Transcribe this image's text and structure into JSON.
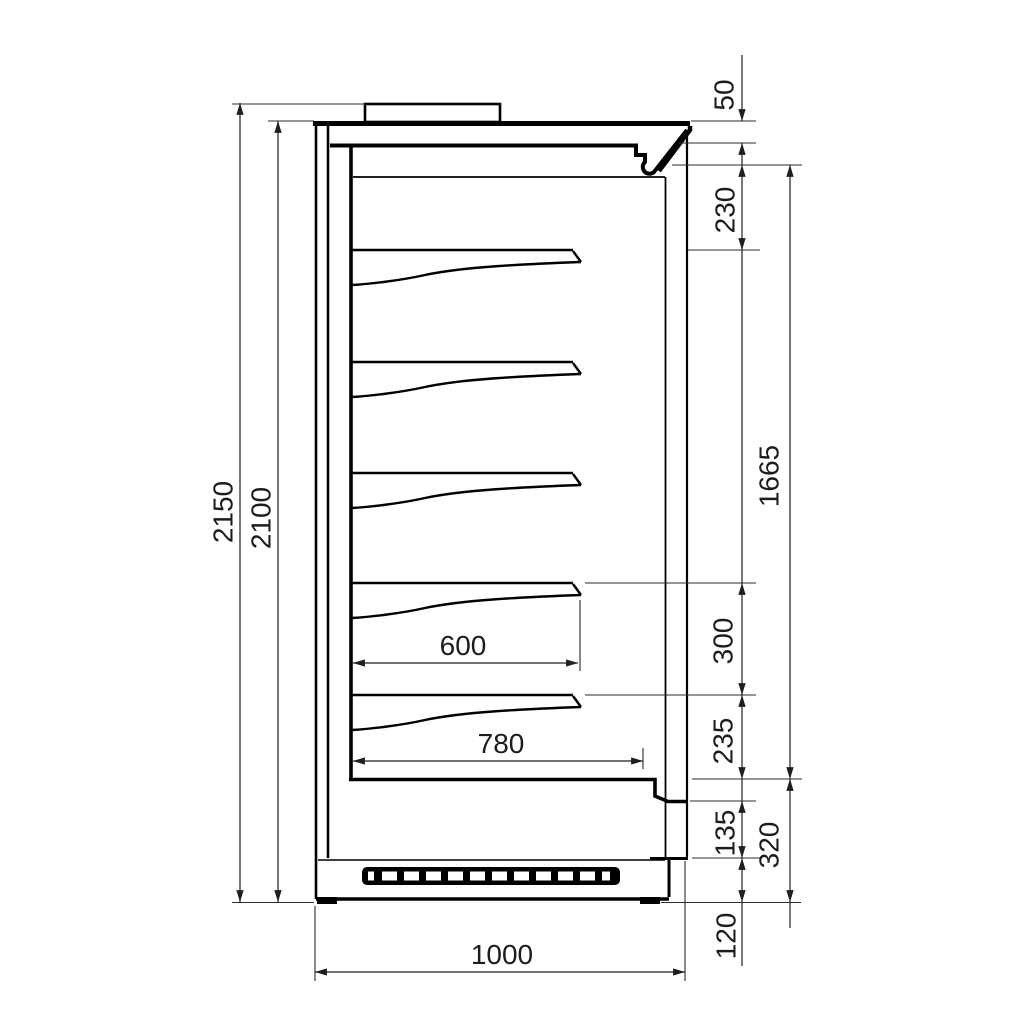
{
  "dims": {
    "overall_height": "2150",
    "cabinet_height": "2100",
    "canopy_height": "50",
    "top_clearance": "230",
    "display_opening": "1665",
    "shelf_spacing": "300",
    "bottom_clearance": "235",
    "front_panel_height": "135",
    "base_section_height": "320",
    "plinth_height": "120",
    "shelf_depth": "600",
    "interior_depth": "780",
    "overall_depth": "1000"
  }
}
